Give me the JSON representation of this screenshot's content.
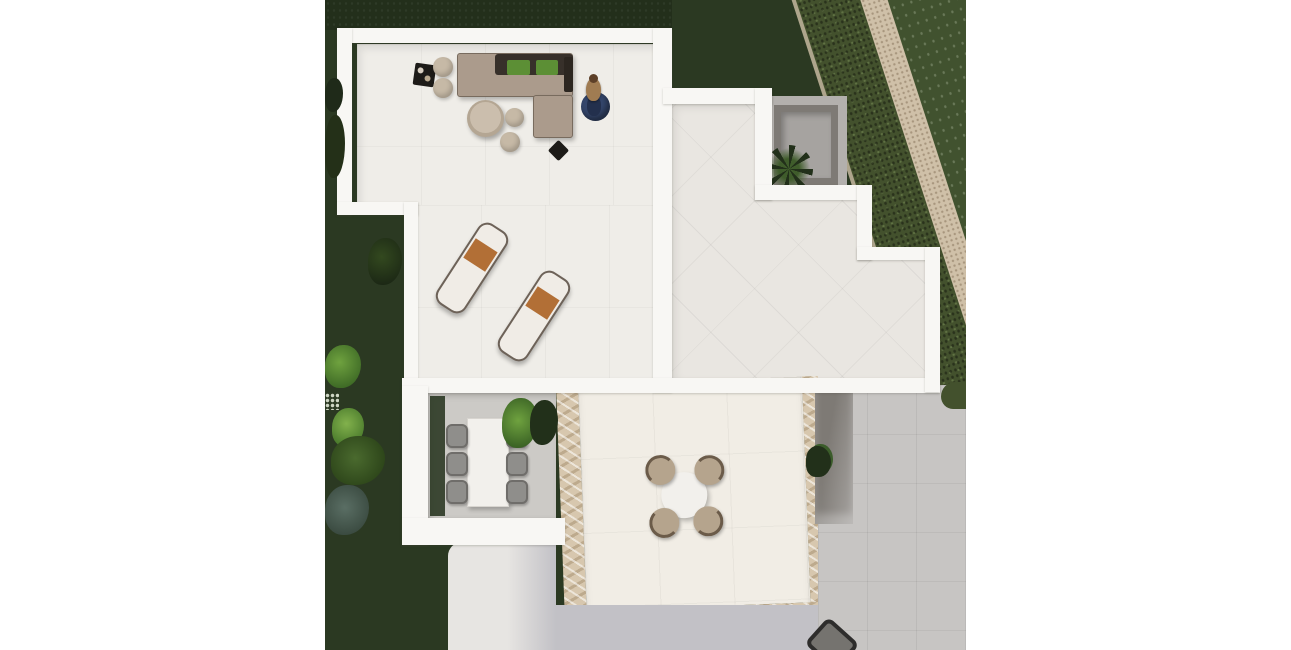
{
  "image": {
    "kind": "aerial 3d architectural render",
    "subject": "top-down view of a villa terrace floor plan with outdoor furniture, garden and paving",
    "width_px": 1291,
    "height_px": 650,
    "photo_area": {
      "left_px": 325,
      "right_px": 966
    }
  },
  "palette": {
    "margin": "#ffffff",
    "grass": "#2b3922",
    "grass_top": "#232f1b",
    "lawn": "#41522f",
    "hedge": "#43512d",
    "gravel": "#cfc0a8",
    "wall": "#f8f7f4",
    "floor": "#efede8",
    "floor_diag": "#e9e6e1",
    "terrace": "#f1ede5",
    "travertine": "#d7c7ae",
    "paving": "#c7c5c3",
    "paving_lav": "#c2c1c6",
    "paving_light": "#e7e5e2",
    "patio_floor": "#cccac6",
    "lightwell_pav": "#b3b0ad",
    "sunken": "#7e7a75",
    "sunken_floor": "#a6a3a0",
    "sofa": "#ab9b8c",
    "cushion": "#37302a",
    "pillow": "#5c8f35",
    "pouf": "#c6b9a6",
    "table_wood": "#b4a693",
    "table_white": "#f2f0ec",
    "rug": "#34466b",
    "skin": "#a07c52",
    "towel": "#b26f36",
    "lounger": "#f0ece6",
    "lounger_frame": "#6d6258",
    "chair_gray": "#8f8e8b",
    "chair_tan": "#b5a48d",
    "chair_rim": "#6b5b49",
    "plant_bright": "#6fa23f",
    "plant_olive": "#4a6a2e",
    "plant_dark": "#22301a",
    "plant_blue": "#5a6e64",
    "black": "#1d1b18"
  },
  "scene": {
    "areas": [
      "lounge terrace with L-shaped outdoor sofa set",
      "stepped diagonal-tiled patio with sunken lightwell and palm",
      "sun-lounger terrace with two loungers",
      "travertine-bordered dining terrace with round table and four chairs",
      "walled patio with rectangular table and six chairs",
      "sunken courtyard beside dining terrace",
      "lawn with diagonal hedge and gravel path",
      "concrete paving with partially visible chair at bottom edge"
    ],
    "people": [
      "one person standing on a round blue rug"
    ]
  }
}
